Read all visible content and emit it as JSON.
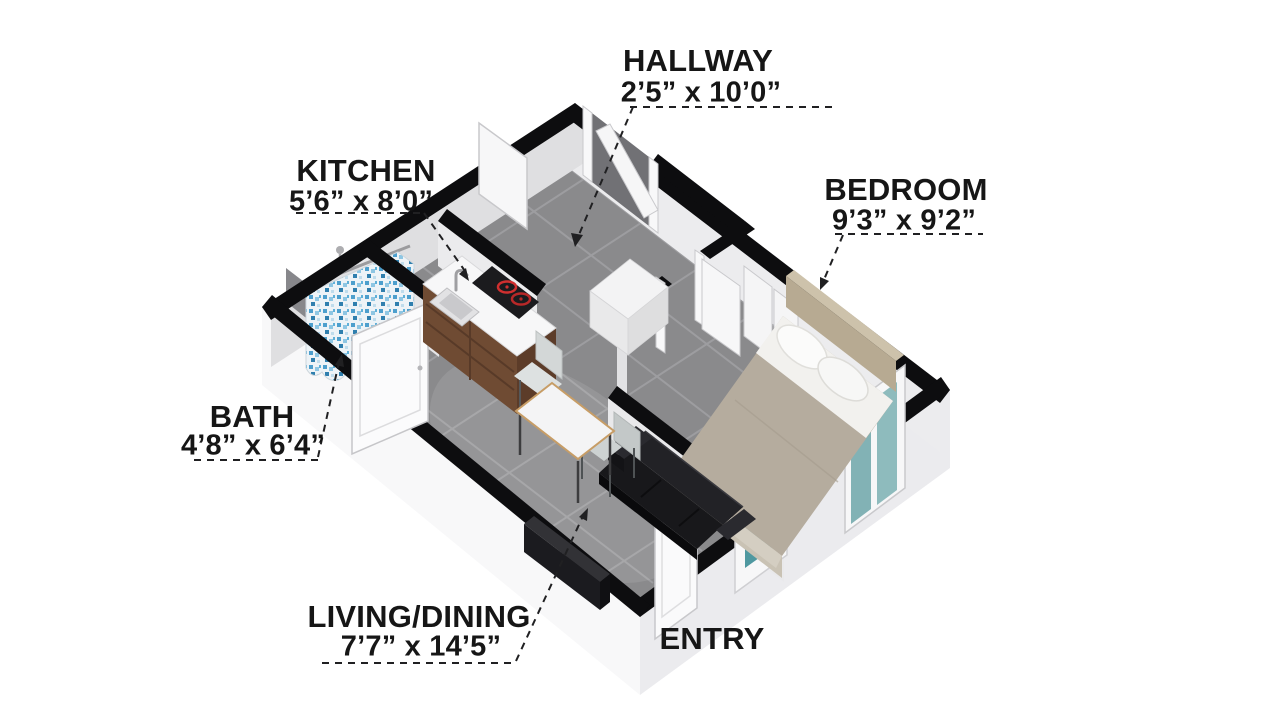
{
  "figure": {
    "type": "3d-isometric-floor-plan",
    "rooms": [
      {
        "id": "hallway",
        "name": "HALLWAY",
        "dims": "2’5” x 10’0”"
      },
      {
        "id": "kitchen",
        "name": "KITCHEN",
        "dims": "5’6” x 8’0”"
      },
      {
        "id": "bedroom",
        "name": "BEDROOM",
        "dims": "9’3” x 9’2”"
      },
      {
        "id": "bath",
        "name": "BATH",
        "dims": "4’8” x 6’4”"
      },
      {
        "id": "living_dining",
        "name": "LIVING/DINING",
        "dims": "7’7” x 14’5”"
      },
      {
        "id": "entry",
        "name": "ENTRY",
        "dims": ""
      }
    ],
    "colors": {
      "wall_top": "#0d0d0f",
      "wall_face_inner": "#e6e6e8",
      "plinth": "#f5f5f6",
      "floor_tile": "#8a8a8c",
      "tile_grout": "#9d9da0",
      "counter_top": "#f7f7f8",
      "cabinet_wood": "#6f4b33",
      "burner_red": "#cf2f2f",
      "shower_curtain_blue": "#4d9fcd",
      "window_glass_teal": "#4f98a0",
      "sofa_black": "#18181b",
      "bed_blanket_taupe": "#b5ac9e",
      "headboard_tan": "#b7aa92",
      "label_text": "#161616"
    }
  }
}
